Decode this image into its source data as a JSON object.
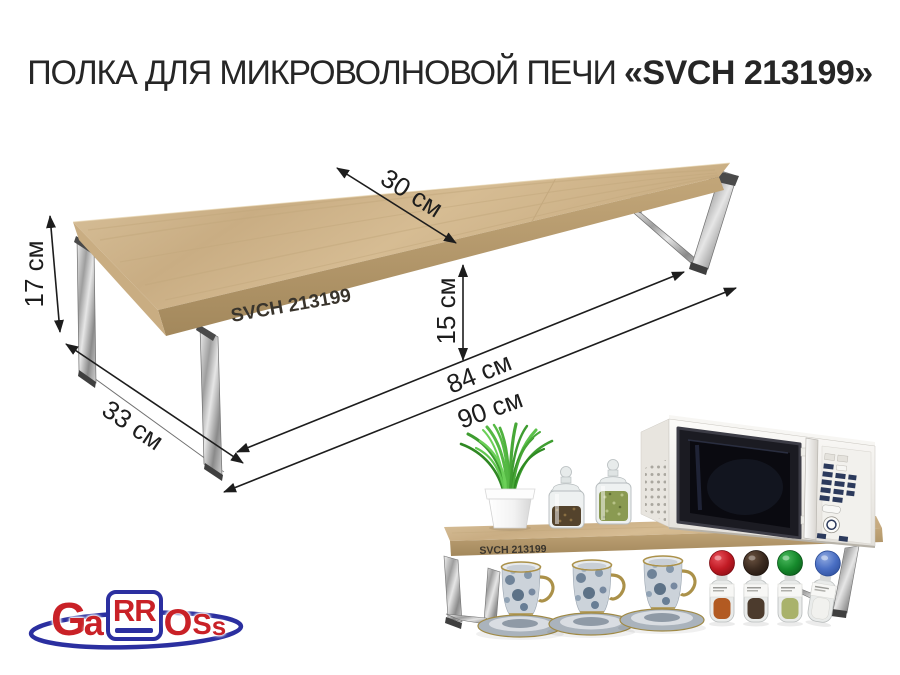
{
  "title": {
    "prefix": "ПОЛКА ДЛЯ МИКРОВОЛНОВОЙ ПЕЧИ ",
    "model": "«SVCH 213199»"
  },
  "diagram": {
    "product_label": "SVCH 213199",
    "dimensions": {
      "top_depth": "30 см",
      "left_height": "17 см",
      "side_depth": "33 см",
      "under_clearance": "15 см",
      "inner_length": "84 см",
      "total_length": "90 см"
    }
  },
  "lifestyle": {
    "product_label": "SVCH 213199"
  },
  "logo": {
    "letters": [
      "G",
      "a",
      "RR",
      "O",
      "S",
      "s"
    ]
  },
  "colors": {
    "wood": "#cdb58c",
    "wood_edge": "#b0946a",
    "chrome": "#c9c9c9",
    "ink": "#1d1d1d",
    "logo_red": "#c92127",
    "logo_blue": "#2b2fa0"
  }
}
